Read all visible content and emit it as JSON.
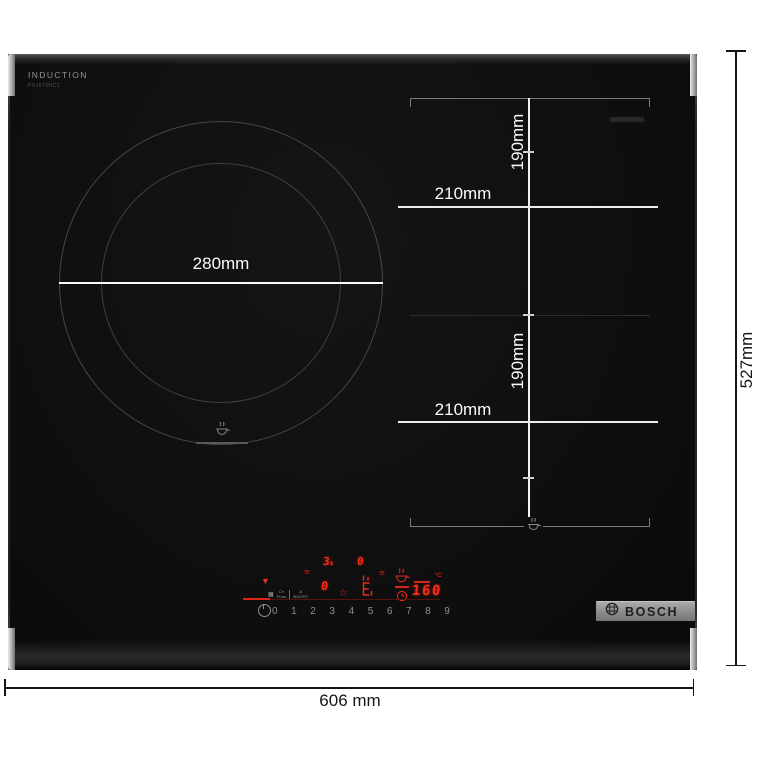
{
  "hob": {
    "brand_print": "INDUCTION",
    "model_print": "PXJ675HC1"
  },
  "zones": {
    "left_circle": {
      "diameter_label": "280mm"
    },
    "flex_top": {
      "depth_label": "190mm",
      "width_label": "210mm"
    },
    "flex_bottom": {
      "depth_label": "190mm",
      "width_label": "210mm"
    }
  },
  "outer_dimensions": {
    "width_label": "606 mm",
    "depth_label": "527mm"
  },
  "control_panel": {
    "heat_icon": "▼",
    "menu_glyph": "≡",
    "star_glyph": "☆",
    "pause_value": "3",
    "pause_suffix": "s",
    "display_a": "0",
    "display_b": "0",
    "temperature_value": "160",
    "temperature_unit": "°C",
    "function_keys": {
      "grid_glyph": "▦",
      "c_label": "C»",
      "func_label": "Func",
      "a_label": "A",
      "boost_label": "BOOST"
    },
    "power_levels": [
      "0",
      "1",
      "2",
      "3",
      "4",
      "5",
      "6",
      "7",
      "8",
      "9"
    ],
    "level_separator": "·"
  },
  "brand_badge": {
    "name": "BOSCH"
  },
  "colors": {
    "glass_black": "#0f0f0f",
    "led_red": "#ff2b1a",
    "accent_red": "#e02317",
    "dim_white": "#fafafa",
    "ring_gray": "#464646",
    "trim_silver": "#a8a8a8",
    "ink_black": "#151515"
  }
}
